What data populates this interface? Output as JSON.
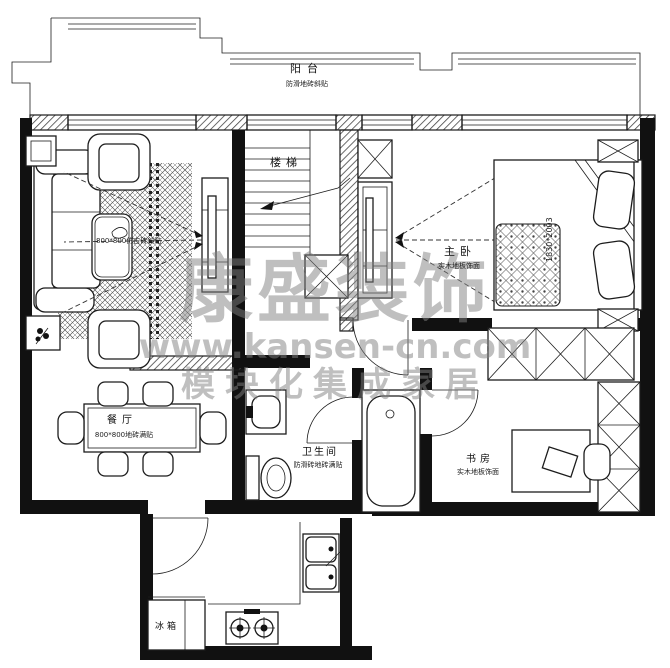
{
  "watermark": {
    "brand": "康盛装饰",
    "site": "www.kansen-cn.com",
    "slogan": "模块化集成家居"
  },
  "labels": {
    "balcony": "阳台",
    "balcony_note": "防滑地砖斜贴",
    "stairs": "楼梯",
    "living_note": "800*800仿古砖斜贴",
    "bedroom": "主卧",
    "bedroom_note": "实木地板饰面",
    "bed_size": "1830*2003",
    "bathroom": "卫生间",
    "bathroom_note": "防滑砖地砖满贴",
    "dining": "餐厅",
    "dining_note": "800*800地砖满贴",
    "study": "书房",
    "study_note": "实木地板饰面",
    "fridge": "冰箱"
  },
  "colors": {
    "line": "#1c1c1c",
    "watermark": "#808080",
    "background": "#ffffff"
  }
}
